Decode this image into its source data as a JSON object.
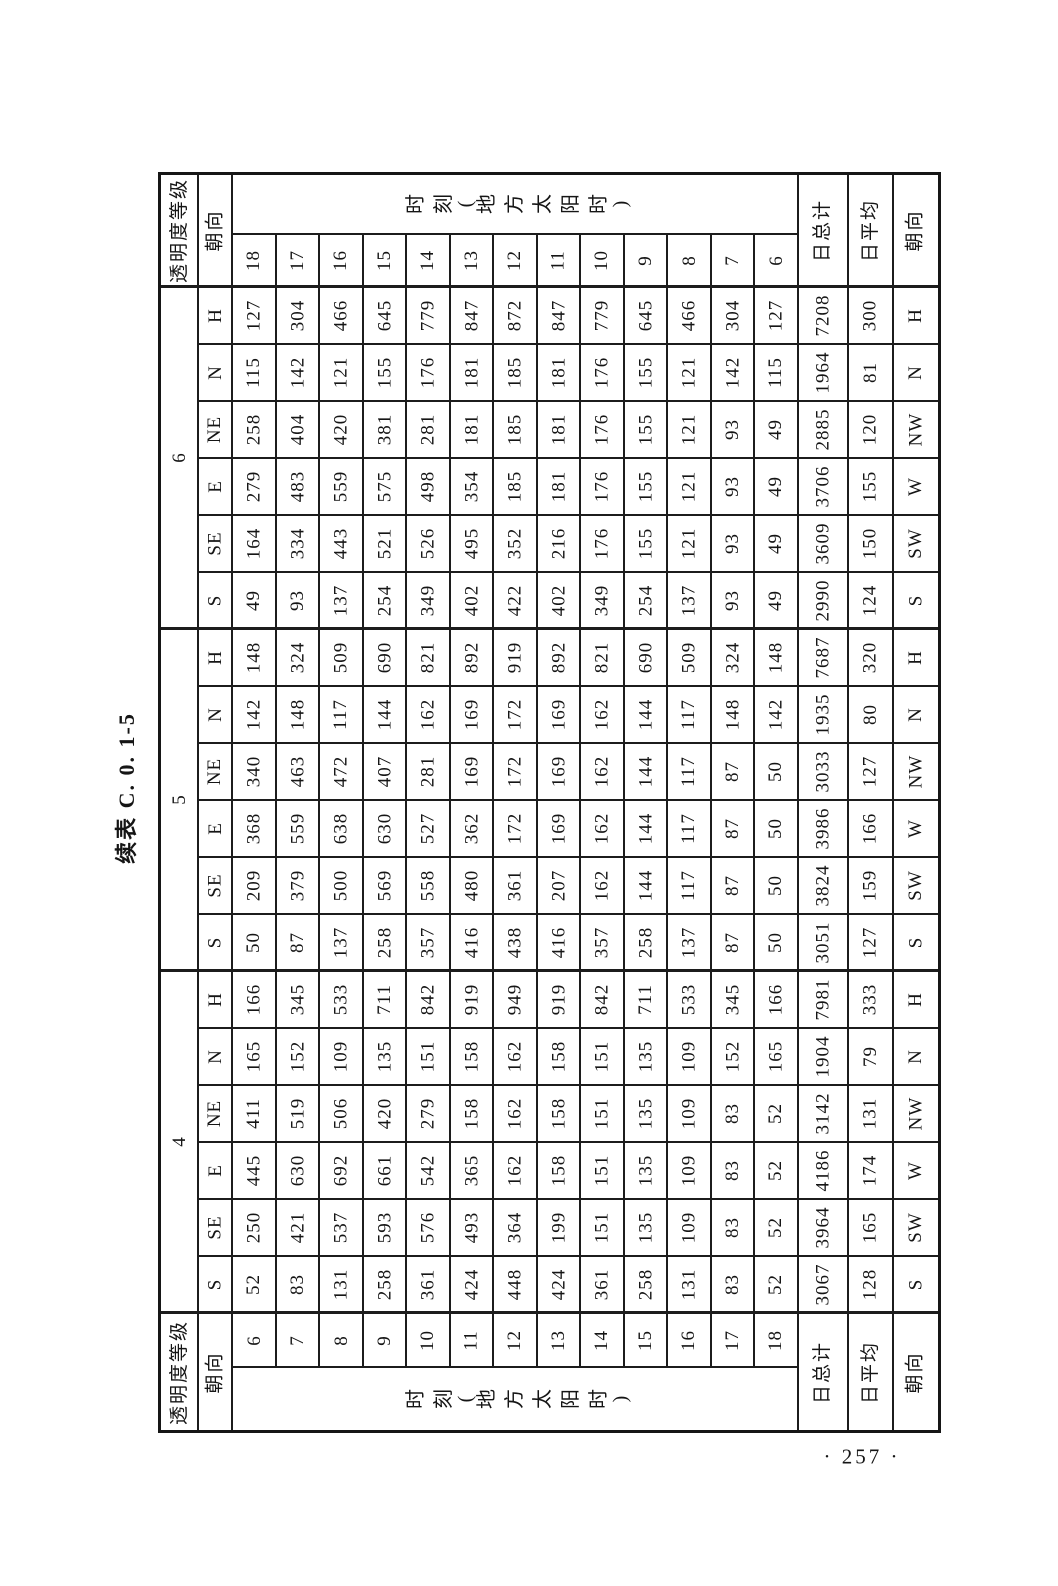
{
  "page": {
    "caption": "续表 C. 0. 1-5",
    "page_number": "257",
    "page_number_display": "· 257 ·"
  },
  "table": {
    "headers": {
      "grade": "透明度等级",
      "orientation": "朝向",
      "time": "时刻(地方太阳时)",
      "daily_total": "日总计",
      "daily_average": "日平均"
    },
    "top_times": [
      "18",
      "17",
      "16",
      "15",
      "14",
      "13",
      "12",
      "11",
      "10",
      "9",
      "8",
      "7",
      "6"
    ],
    "bottom_times": [
      "6",
      "7",
      "8",
      "9",
      "10",
      "11",
      "12",
      "13",
      "14",
      "15",
      "16",
      "17",
      "18"
    ],
    "groups": [
      {
        "grade": "6",
        "rows": [
          {
            "left": "H",
            "values": [
              127,
              304,
              466,
              645,
              779,
              847,
              872,
              847,
              779,
              645,
              466,
              304,
              127
            ],
            "daily_total": 7208,
            "daily_average": 300,
            "right": "H"
          },
          {
            "left": "N",
            "values": [
              115,
              142,
              121,
              155,
              176,
              181,
              185,
              181,
              176,
              155,
              121,
              142,
              115
            ],
            "daily_total": 1964,
            "daily_average": 81,
            "right": "N"
          },
          {
            "left": "NE",
            "values": [
              258,
              404,
              420,
              381,
              281,
              181,
              185,
              181,
              176,
              155,
              121,
              93,
              49
            ],
            "daily_total": 2885,
            "daily_average": 120,
            "right": "NW"
          },
          {
            "left": "E",
            "values": [
              279,
              483,
              559,
              575,
              498,
              354,
              185,
              181,
              176,
              155,
              121,
              93,
              49
            ],
            "daily_total": 3706,
            "daily_average": 155,
            "right": "W"
          },
          {
            "left": "SE",
            "values": [
              164,
              334,
              443,
              521,
              526,
              495,
              352,
              216,
              176,
              155,
              121,
              93,
              49
            ],
            "daily_total": 3609,
            "daily_average": 150,
            "right": "SW"
          },
          {
            "left": "S",
            "values": [
              49,
              93,
              137,
              254,
              349,
              402,
              422,
              402,
              349,
              254,
              137,
              93,
              49
            ],
            "daily_total": 2990,
            "daily_average": 124,
            "right": "S"
          }
        ]
      },
      {
        "grade": "5",
        "rows": [
          {
            "left": "H",
            "values": [
              148,
              324,
              509,
              690,
              821,
              892,
              919,
              892,
              821,
              690,
              509,
              324,
              148
            ],
            "daily_total": 7687,
            "daily_average": 320,
            "right": "H"
          },
          {
            "left": "N",
            "values": [
              142,
              148,
              117,
              144,
              162,
              169,
              172,
              169,
              162,
              144,
              117,
              148,
              142
            ],
            "daily_total": 1935,
            "daily_average": 80,
            "right": "N"
          },
          {
            "left": "NE",
            "values": [
              340,
              463,
              472,
              407,
              281,
              169,
              172,
              169,
              162,
              144,
              117,
              87,
              50
            ],
            "daily_total": 3033,
            "daily_average": 127,
            "right": "NW"
          },
          {
            "left": "E",
            "values": [
              368,
              559,
              638,
              630,
              527,
              362,
              172,
              169,
              162,
              144,
              117,
              87,
              50
            ],
            "daily_total": 3986,
            "daily_average": 166,
            "right": "W"
          },
          {
            "left": "SE",
            "values": [
              209,
              379,
              500,
              569,
              558,
              480,
              361,
              207,
              162,
              144,
              117,
              87,
              50
            ],
            "daily_total": 3824,
            "daily_average": 159,
            "right": "SW"
          },
          {
            "left": "S",
            "values": [
              50,
              87,
              137,
              258,
              357,
              416,
              438,
              416,
              357,
              258,
              137,
              87,
              50
            ],
            "daily_total": 3051,
            "daily_average": 127,
            "right": "S"
          }
        ]
      },
      {
        "grade": "4",
        "rows": [
          {
            "left": "H",
            "values": [
              166,
              345,
              533,
              711,
              842,
              919,
              949,
              919,
              842,
              711,
              533,
              345,
              166
            ],
            "daily_total": 7981,
            "daily_average": 333,
            "right": "H"
          },
          {
            "left": "N",
            "values": [
              165,
              152,
              109,
              135,
              151,
              158,
              162,
              158,
              151,
              135,
              109,
              152,
              165
            ],
            "daily_total": 1904,
            "daily_average": 79,
            "right": "N"
          },
          {
            "left": "NE",
            "values": [
              411,
              519,
              506,
              420,
              279,
              158,
              162,
              158,
              151,
              135,
              109,
              83,
              52
            ],
            "daily_total": 3142,
            "daily_average": 131,
            "right": "NW"
          },
          {
            "left": "E",
            "values": [
              445,
              630,
              692,
              661,
              542,
              365,
              162,
              158,
              151,
              135,
              109,
              83,
              52
            ],
            "daily_total": 4186,
            "daily_average": 174,
            "right": "W"
          },
          {
            "left": "SE",
            "values": [
              250,
              421,
              537,
              593,
              576,
              493,
              364,
              199,
              151,
              135,
              109,
              83,
              52
            ],
            "daily_total": 3964,
            "daily_average": 165,
            "right": "SW"
          },
          {
            "left": "S",
            "values": [
              52,
              83,
              131,
              258,
              361,
              424,
              448,
              424,
              361,
              258,
              131,
              83,
              52
            ],
            "daily_total": 3067,
            "daily_average": 128,
            "right": "S"
          }
        ]
      }
    ]
  }
}
